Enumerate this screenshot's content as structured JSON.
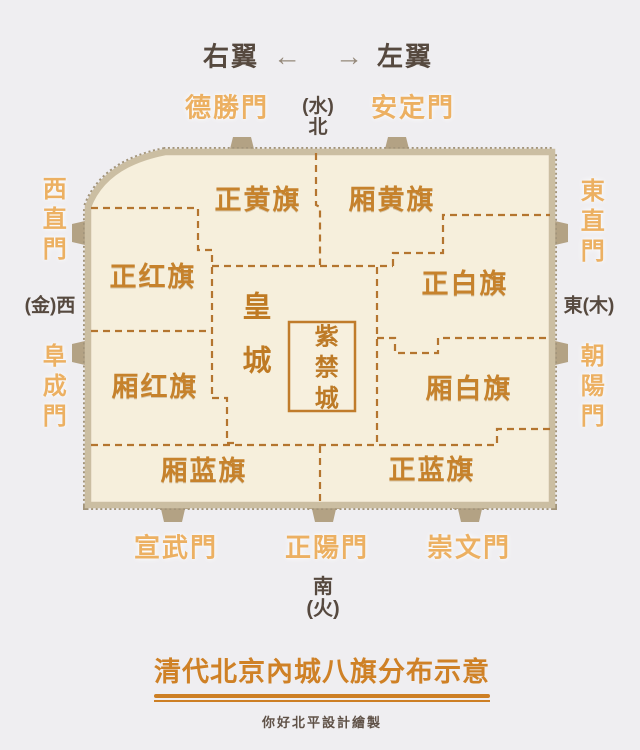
{
  "header": {
    "right_wing": "右翼",
    "left_wing": "左翼",
    "left_arrow": "←",
    "right_arrow": "→"
  },
  "directions": {
    "north_element": "(水)",
    "north": "北",
    "west": "(金)西",
    "east": "東(木)",
    "south": "南",
    "south_element": "(火)"
  },
  "gates": {
    "deshengmen": "德勝門",
    "andingmen": "安定門",
    "xizhimen": "西直門",
    "fuchengmen": "阜成門",
    "dongzhimen": "東直門",
    "chaoyangmen": "朝陽門",
    "xuanwumen": "宣武門",
    "zhengyangmen": "正陽門",
    "chongwenmen": "崇文門"
  },
  "banners": {
    "plain_yellow": "正黄旗",
    "bordered_yellow": "厢黄旗",
    "plain_red": "正红旗",
    "bordered_red": "厢红旗",
    "plain_white": "正白旗",
    "bordered_white": "厢白旗",
    "bordered_blue": "厢蓝旗",
    "plain_blue": "正蓝旗"
  },
  "center_city": {
    "imperial_city": "皇城",
    "forbidden_city": "紫禁城"
  },
  "footer": {
    "title": "清代北京內城八旗分布示意",
    "credit": "你好北平設計繪製"
  },
  "colors": {
    "page_bg": "#efeef1",
    "map_fill": "#f6efdc",
    "wall_band": "#cbbea2",
    "wall_stitch": "#a2947a",
    "tower": "#b3a284",
    "boundary_dash": "#b4752f",
    "banner_text": "#c6822c",
    "gate_text": "#ecb062",
    "dark_text": "#56493f",
    "title_text": "#cf8126"
  }
}
